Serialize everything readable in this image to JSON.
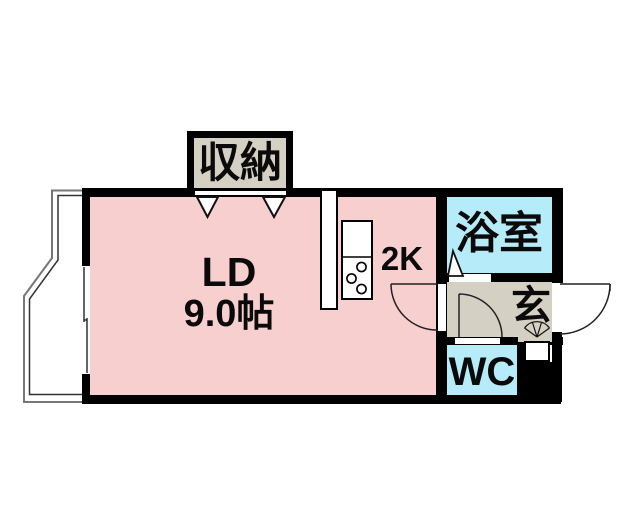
{
  "plan": {
    "type": "apartment-floor-plan",
    "rooms": {
      "living_dining": {
        "label": "LD",
        "size": "9.0帖"
      },
      "kitchen": {
        "label": "2K"
      },
      "bathroom": {
        "label": "浴室"
      },
      "entrance": {
        "label": "玄"
      },
      "toilet": {
        "label": "WC"
      },
      "storage": {
        "label": "収納"
      }
    },
    "colors": {
      "living_dining_fill": "#f8cfcf",
      "bathroom_toilet_fill": "#b6ecfa",
      "storage_entrance_fill": "#d4d0c3",
      "wall": "#000000",
      "balcony_line": "#777777"
    }
  }
}
